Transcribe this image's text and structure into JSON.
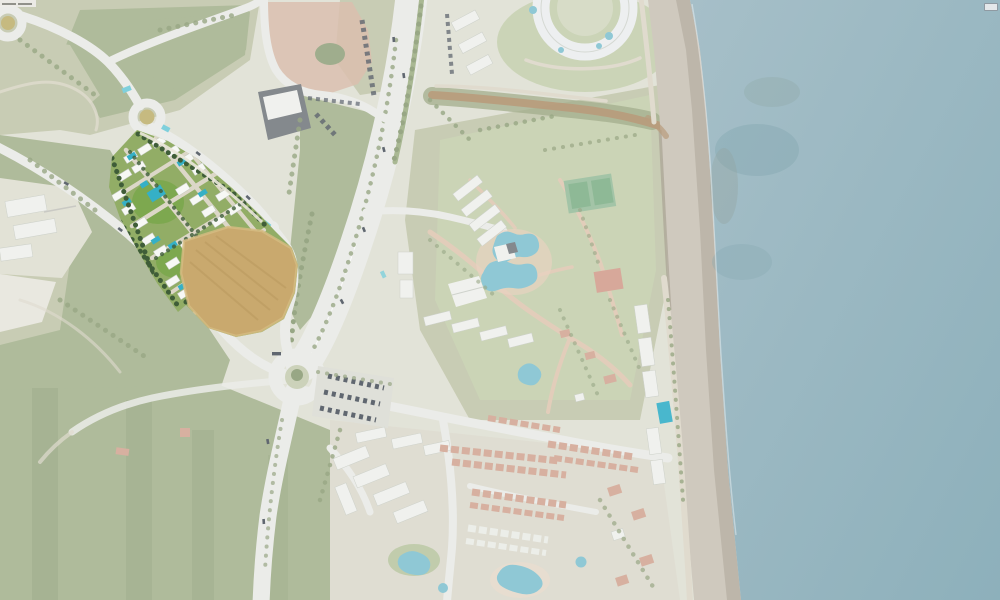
{
  "overlays": {
    "attribution": {
      "text": "",
      "note": "tiny illegible map-credit watermark"
    },
    "control_button": {
      "label": ""
    }
  },
  "colors": {
    "land": "#e2e3d8",
    "scrub": "#c6cab0",
    "forest": "#aab795",
    "forest_dark": "#98a785",
    "ocean": "#a2bcc6",
    "ocean_deep": "#8db0bb",
    "beach": "#cfc9be",
    "beach_wet": "#b8b1a5",
    "road": "#ebece9",
    "median_green": "#a9b893",
    "dirt": "#d9bcaa",
    "river": "#b89b7c",
    "bank": "#a3ae8c",
    "white_bldg": "#f0f1ee",
    "dark_bldg": "#84898d",
    "red_roof": "#d7b0a0",
    "pool": "#8fc8d5",
    "court_green": "#a3c4a7",
    "court_red": "#d7a89a",
    "cyan_mark": "#7fd0dc",
    "car_dark": "#606770",
    "site_lawn": "#92ad66",
    "site_lawn2": "#7da84f",
    "site_hedge": "#3f5d38",
    "site_path": "#dcd7c8",
    "site_white": "#f7f8f5",
    "site_pool": "#35b0c6",
    "site_field": "#c9a96e",
    "site_field_line": "#b6955a",
    "rb_island": "#c6ba80",
    "attribution_bg": "#efeeea",
    "button_bg": "#e4e8ea",
    "button_border": "#8f9aa2"
  }
}
